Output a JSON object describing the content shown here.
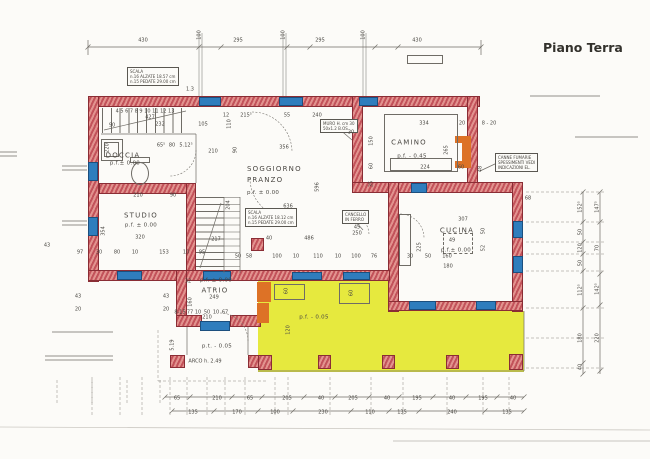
{
  "title": "Piano Terra",
  "colors": {
    "wall_fill": "#c2525a",
    "wall_light": "#e2938f",
    "wall_outline": "#8a2d35",
    "window_blue": "#2f7dbd",
    "porch_yellow": "#e6e93e",
    "fixture_orange": "#dd7226",
    "line_gray": "#6f6c66",
    "text": "#4a4742"
  },
  "rooms": {
    "soggiorno": {
      "line1": "SOGGIORNO",
      "line2": "PRANZO",
      "level": "p.f. ± 0.00"
    },
    "doccia": {
      "label": "DOCCIA",
      "level": "p.f.± 0.00"
    },
    "studio": {
      "label": "STUDIO",
      "level": "p.f. ± 0.00"
    },
    "camino": {
      "label": "CAMINO",
      "level": "p.f. - 0.45"
    },
    "cucina": {
      "label": "CUCINA",
      "level": "p.f.± 0.00"
    },
    "atrio": {
      "label": "ATRIO",
      "level": "p.f. ± 0.00"
    },
    "ingresso": {
      "level": "p.t. - 0.05"
    },
    "portico": {
      "level": "p.f. - 0.05"
    }
  },
  "annotations": {
    "scala_nord": [
      "SCALA",
      "n.16 ALZATE 18.57 cm",
      "n.15 PEDATE 29.00 cm"
    ],
    "scala_sud": [
      "SCALA",
      "n.16 ALZATE 18.12 cm",
      "n.15 PEDATE 29.00 cm"
    ],
    "muro": [
      "MURO H. cm 30",
      "50x1.2 B.OS"
    ],
    "canne_fumarie": [
      "CANNE FUMARIE",
      "SPESSIMENTI VEDI",
      "INDICAZIONI  EL."
    ],
    "cancello": [
      "CANCELLO",
      "IN FERRO"
    ],
    "arco": "ARCO  h. 2.49"
  },
  "dim_labels": [
    {
      "t": "430",
      "x": 143,
      "y": 41
    },
    {
      "t": "295",
      "x": 238,
      "y": 41
    },
    {
      "t": "295",
      "x": 320,
      "y": 41
    },
    {
      "t": "430",
      "x": 417,
      "y": 41
    },
    {
      "t": "100",
      "x": 200,
      "y": 35,
      "r": 1
    },
    {
      "t": "100",
      "x": 284,
      "y": 35,
      "r": 1
    },
    {
      "t": "100",
      "x": 364,
      "y": 35,
      "r": 1
    },
    {
      "t": "1.3",
      "x": 190,
      "y": 90
    },
    {
      "t": "4  5  6  7  8  9  10  11  12  13",
      "x": 145,
      "y": 112
    },
    {
      "t": "427",
      "x": 150,
      "y": 118
    },
    {
      "t": "90",
      "x": 112,
      "y": 126
    },
    {
      "t": "232",
      "x": 160,
      "y": 125
    },
    {
      "t": "105",
      "x": 203,
      "y": 125
    },
    {
      "t": "12",
      "x": 226,
      "y": 116
    },
    {
      "t": "215⁵",
      "x": 246,
      "y": 116
    },
    {
      "t": "55",
      "x": 287,
      "y": 116
    },
    {
      "t": "240",
      "x": 317,
      "y": 116
    },
    {
      "t": "110",
      "x": 230,
      "y": 124,
      "r": 1
    },
    {
      "t": "356",
      "x": 284,
      "y": 148
    },
    {
      "t": "90",
      "x": 236,
      "y": 150,
      "r": 1
    },
    {
      "t": "596",
      "x": 318,
      "y": 187,
      "r": 1
    },
    {
      "t": "204",
      "x": 229,
      "y": 205,
      "r": 1
    },
    {
      "t": "636",
      "x": 288,
      "y": 207
    },
    {
      "t": "220",
      "x": 108,
      "y": 148,
      "r": 1
    },
    {
      "t": "65⁵",
      "x": 161,
      "y": 146
    },
    {
      "t": "80",
      "x": 172,
      "y": 146
    },
    {
      "t": "5.12⁵",
      "x": 186,
      "y": 146
    },
    {
      "t": "210",
      "x": 213,
      "y": 152
    },
    {
      "t": "210",
      "x": 138,
      "y": 196
    },
    {
      "t": "90",
      "x": 173,
      "y": 196
    },
    {
      "t": "354",
      "x": 104,
      "y": 231,
      "r": 1
    },
    {
      "t": "320",
      "x": 140,
      "y": 238
    },
    {
      "t": "217",
      "x": 216,
      "y": 240
    },
    {
      "t": "486",
      "x": 309,
      "y": 239
    },
    {
      "t": "97",
      "x": 80,
      "y": 253
    },
    {
      "t": "30",
      "x": 99,
      "y": 253
    },
    {
      "t": "80",
      "x": 117,
      "y": 253
    },
    {
      "t": "10",
      "x": 135,
      "y": 253
    },
    {
      "t": "153",
      "x": 164,
      "y": 253
    },
    {
      "t": "10",
      "x": 186,
      "y": 253
    },
    {
      "t": "95",
      "x": 202,
      "y": 253
    },
    {
      "t": "50",
      "x": 238,
      "y": 257
    },
    {
      "t": "58",
      "x": 249,
      "y": 257
    },
    {
      "t": "100",
      "x": 277,
      "y": 257
    },
    {
      "t": "10",
      "x": 296,
      "y": 257
    },
    {
      "t": "110",
      "x": 318,
      "y": 257
    },
    {
      "t": "10",
      "x": 338,
      "y": 257
    },
    {
      "t": "100",
      "x": 356,
      "y": 257
    },
    {
      "t": "76",
      "x": 374,
      "y": 257
    },
    {
      "t": "30",
      "x": 410,
      "y": 257
    },
    {
      "t": "50",
      "x": 428,
      "y": 257
    },
    {
      "t": "160",
      "x": 447,
      "y": 257
    },
    {
      "t": "30",
      "x": 351,
      "y": 133
    },
    {
      "t": "150",
      "x": 372,
      "y": 141,
      "r": 1
    },
    {
      "t": "60",
      "x": 372,
      "y": 166,
      "r": 1
    },
    {
      "t": "35",
      "x": 372,
      "y": 184,
      "r": 1
    },
    {
      "t": "334",
      "x": 424,
      "y": 124
    },
    {
      "t": "20",
      "x": 462,
      "y": 124
    },
    {
      "t": "8 - 20",
      "x": 489,
      "y": 124
    },
    {
      "t": "265",
      "x": 447,
      "y": 150,
      "r": 1
    },
    {
      "t": "224",
      "x": 425,
      "y": 168
    },
    {
      "t": "60",
      "x": 461,
      "y": 168
    },
    {
      "t": "48",
      "x": 481,
      "y": 169,
      "r": 1
    },
    {
      "t": "68",
      "x": 528,
      "y": 199
    },
    {
      "t": "307",
      "x": 463,
      "y": 220
    },
    {
      "t": "49",
      "x": 452,
      "y": 241
    },
    {
      "t": "180",
      "x": 448,
      "y": 267
    },
    {
      "t": "225",
      "x": 420,
      "y": 247,
      "r": 1
    },
    {
      "t": "50",
      "x": 484,
      "y": 231,
      "r": 1
    },
    {
      "t": "52",
      "x": 484,
      "y": 248,
      "r": 1
    },
    {
      "t": "40",
      "x": 269,
      "y": 239
    },
    {
      "t": "32",
      "x": 188,
      "y": 282
    },
    {
      "t": "249",
      "x": 214,
      "y": 298
    },
    {
      "t": "160",
      "x": 191,
      "y": 302,
      "r": 1
    },
    {
      "t": "43",
      "x": 166,
      "y": 297
    },
    {
      "t": "20",
      "x": 166,
      "y": 310
    },
    {
      "t": "8-15",
      "x": 180,
      "y": 313
    },
    {
      "t": "77",
      "x": 190,
      "y": 313
    },
    {
      "t": "10",
      "x": 198,
      "y": 313
    },
    {
      "t": "50",
      "x": 207,
      "y": 313
    },
    {
      "t": "10",
      "x": 216,
      "y": 313
    },
    {
      "t": "67",
      "x": 225,
      "y": 313
    },
    {
      "t": "210",
      "x": 207,
      "y": 318
    },
    {
      "t": "45",
      "x": 357,
      "y": 228
    },
    {
      "t": "250",
      "x": 357,
      "y": 234
    },
    {
      "t": "5.19",
      "x": 173,
      "y": 345,
      "r": 1
    },
    {
      "t": "120",
      "x": 289,
      "y": 330,
      "r": 1
    },
    {
      "t": "60",
      "x": 287,
      "y": 291,
      "r": 1
    },
    {
      "t": "60",
      "x": 352,
      "y": 293,
      "r": 1
    },
    {
      "t": "43",
      "x": 47,
      "y": 246
    },
    {
      "t": "43",
      "x": 78,
      "y": 297
    },
    {
      "t": "20",
      "x": 78,
      "y": 310
    },
    {
      "t": "65",
      "x": 177,
      "y": 399
    },
    {
      "t": "210",
      "x": 217,
      "y": 399
    },
    {
      "t": "65",
      "x": 250,
      "y": 399
    },
    {
      "t": "205",
      "x": 287,
      "y": 399
    },
    {
      "t": "40",
      "x": 321,
      "y": 399
    },
    {
      "t": "205",
      "x": 353,
      "y": 399
    },
    {
      "t": "40",
      "x": 387,
      "y": 399
    },
    {
      "t": "195",
      "x": 417,
      "y": 399
    },
    {
      "t": "40",
      "x": 452,
      "y": 399
    },
    {
      "t": "195",
      "x": 483,
      "y": 399
    },
    {
      "t": "40",
      "x": 513,
      "y": 399
    },
    {
      "t": "135",
      "x": 193,
      "y": 413
    },
    {
      "t": "170",
      "x": 237,
      "y": 413
    },
    {
      "t": "100",
      "x": 275,
      "y": 413
    },
    {
      "t": "230",
      "x": 323,
      "y": 413
    },
    {
      "t": "110",
      "x": 370,
      "y": 413
    },
    {
      "t": "135",
      "x": 402,
      "y": 413
    },
    {
      "t": "240",
      "x": 452,
      "y": 413
    },
    {
      "t": "135",
      "x": 507,
      "y": 413
    },
    {
      "t": "152⁵",
      "x": 581,
      "y": 207,
      "r": 1
    },
    {
      "t": "50",
      "x": 581,
      "y": 232,
      "r": 1
    },
    {
      "t": "120",
      "x": 581,
      "y": 248,
      "r": 1
    },
    {
      "t": "50",
      "x": 581,
      "y": 263,
      "r": 1
    },
    {
      "t": "112⁵",
      "x": 581,
      "y": 290,
      "r": 1
    },
    {
      "t": "180",
      "x": 581,
      "y": 338,
      "r": 1
    },
    {
      "t": "40",
      "x": 581,
      "y": 367,
      "r": 1
    },
    {
      "t": "147⁵",
      "x": 598,
      "y": 207,
      "r": 1
    },
    {
      "t": "70",
      "x": 598,
      "y": 248,
      "r": 1
    },
    {
      "t": "142⁵",
      "x": 598,
      "y": 289,
      "r": 1
    },
    {
      "t": "220",
      "x": 598,
      "y": 338,
      "r": 1
    }
  ]
}
